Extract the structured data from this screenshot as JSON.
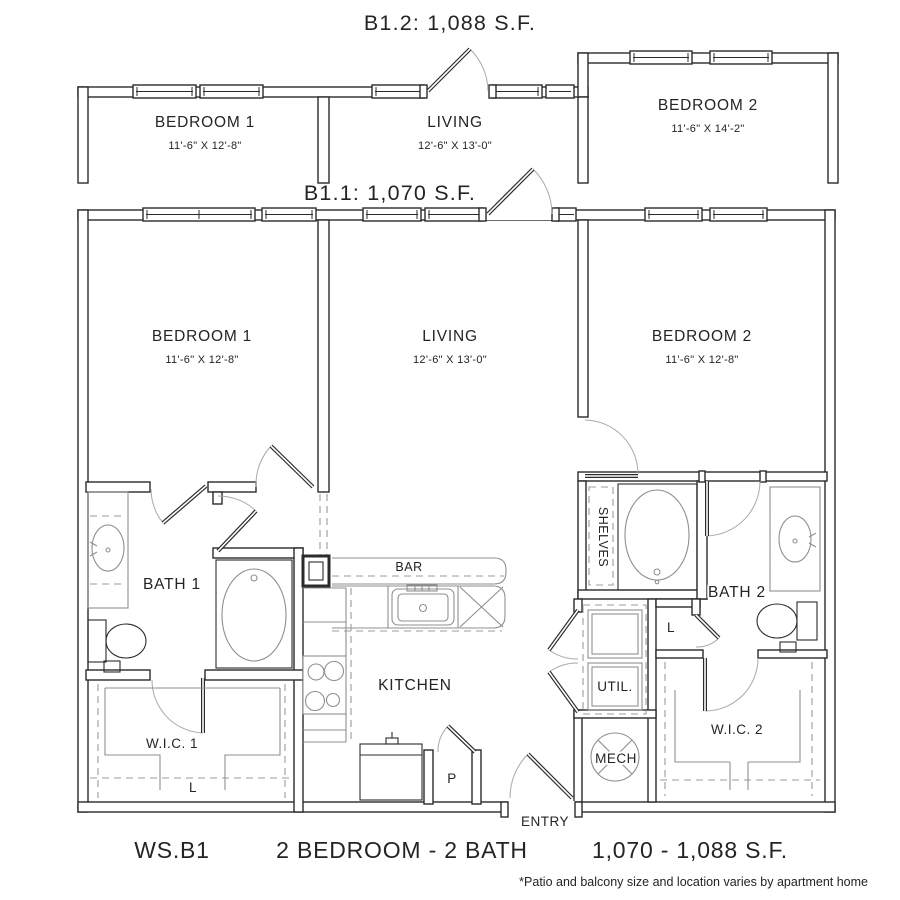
{
  "titles": {
    "b12": "B1.2: 1,088 S.F.",
    "b11": "B1.1: 1,070 S.F."
  },
  "b12": {
    "bedroom1": {
      "name": "BEDROOM 1",
      "dims": "11'-6\" X 12'-8\""
    },
    "living": {
      "name": "LIVING",
      "dims": "12'-6\" X 13'-0\""
    },
    "bedroom2": {
      "name": "BEDROOM 2",
      "dims": "11'-6\" X 14'-2\""
    }
  },
  "b11": {
    "bedroom1": {
      "name": "BEDROOM 1",
      "dims": "11'-6\" X 12'-8\""
    },
    "living": {
      "name": "LIVING",
      "dims": "12'-6\" X 13'-0\""
    },
    "bedroom2": {
      "name": "BEDROOM 2",
      "dims": "11'-6\" X 12'-8\""
    },
    "bath1": "BATH 1",
    "bath2": "BATH 2",
    "wic1": "W.I.C. 1",
    "wic2": "W.I.C. 2",
    "kitchen": "KITCHEN",
    "bar": "BAR",
    "util": "UTIL.",
    "mech": "MECH",
    "shelves": "SHELVES",
    "entry": "ENTRY",
    "pantry": "P",
    "linen1": "L",
    "linen2": "L"
  },
  "footer": {
    "code": "WS.B1",
    "type": "2 BEDROOM - 2 BATH",
    "area": "1,070 - 1,088 S.F.",
    "disclaimer": "*Patio and balcony size and location varies by apartment home"
  },
  "colors": {
    "line": "#2b2b2b",
    "fixture": "#8f8f8f",
    "background": "#ffffff"
  }
}
